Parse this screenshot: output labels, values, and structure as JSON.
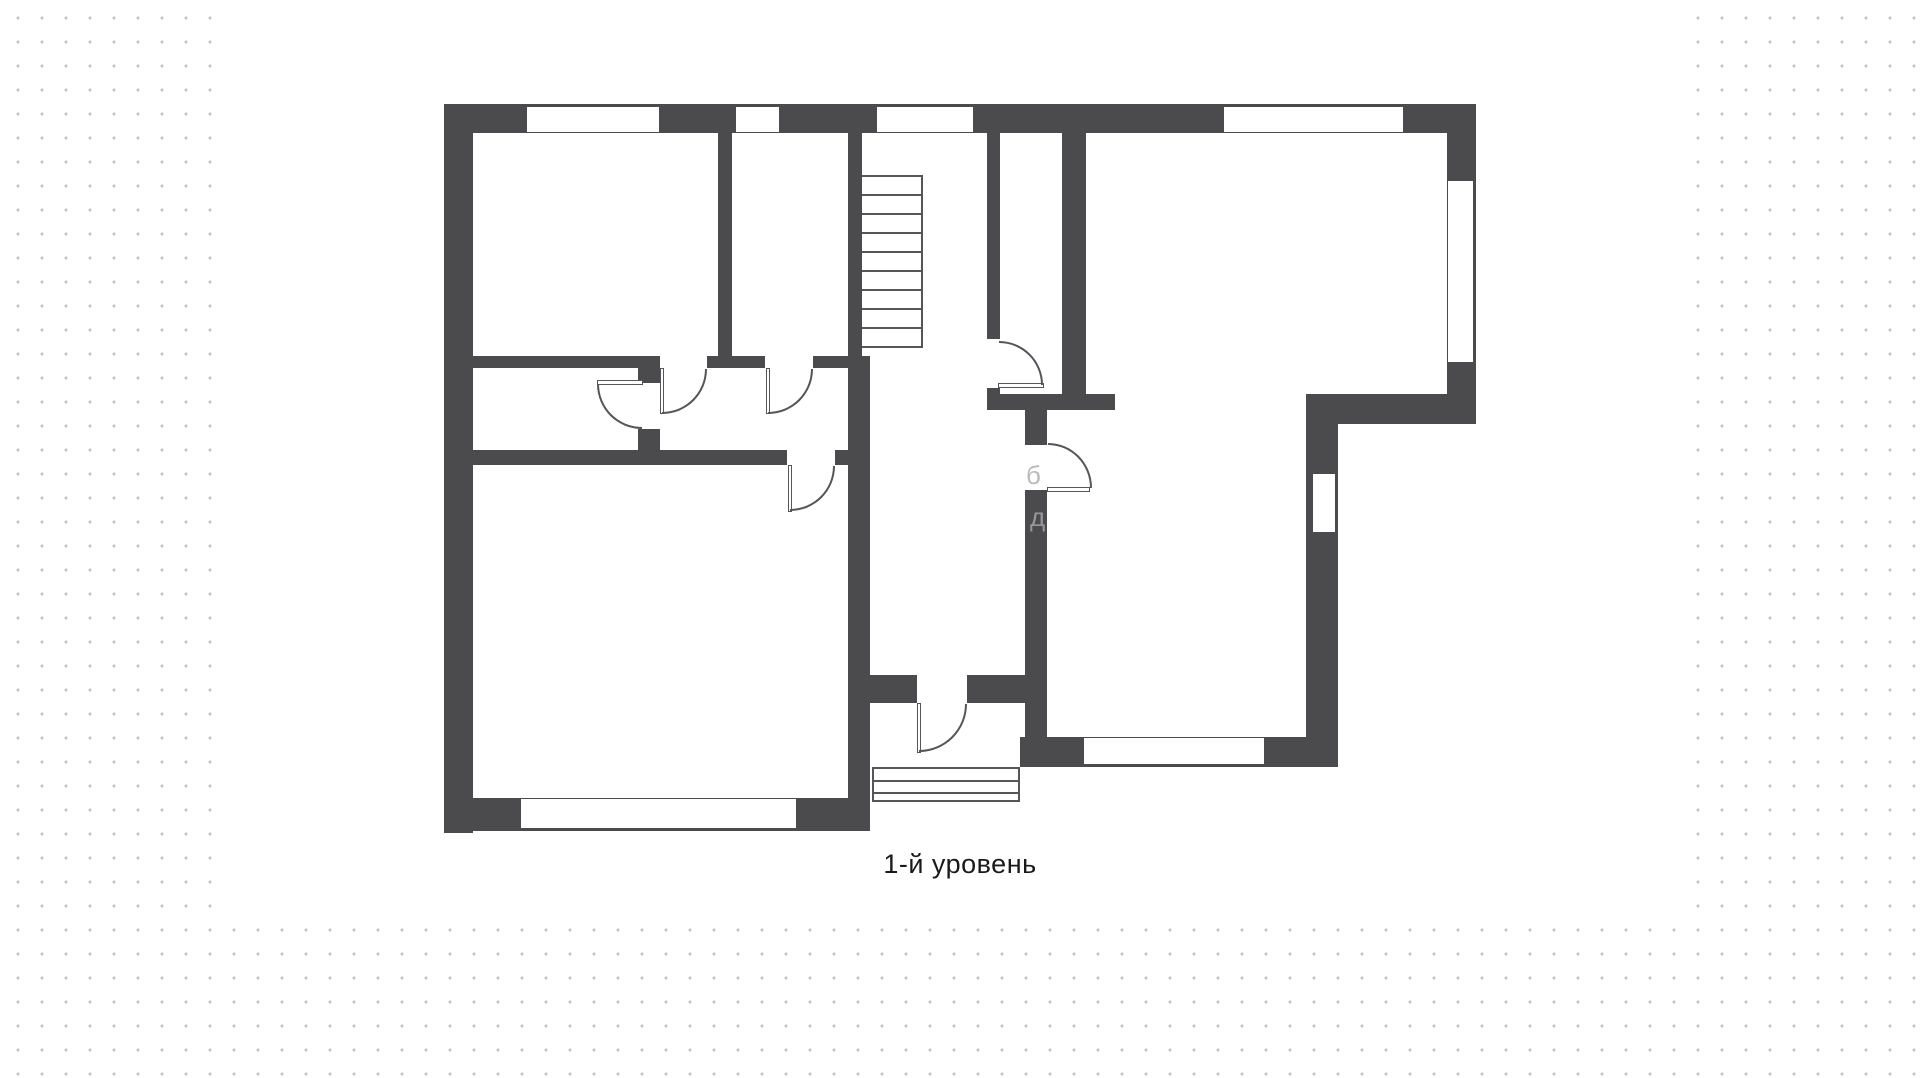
{
  "caption": {
    "text": "1-й уровень"
  },
  "colors": {
    "wall": "#4b4b4d",
    "line": "#55555a",
    "background_dot": "#c5c5c5",
    "sheet": "#ffffff",
    "caption_text": "#1a1a1a",
    "watermark": "#ababab"
  },
  "sheet": {
    "x": 230,
    "y": 0,
    "w": 1462,
    "h": 916
  },
  "plan": {
    "walls": [
      [
        444,
        104,
        1032,
        29
      ],
      [
        444,
        104,
        29,
        729
      ],
      [
        1447,
        104,
        29,
        320
      ],
      [
        1306,
        394,
        170,
        30
      ],
      [
        1306,
        424,
        32,
        343
      ],
      [
        1020,
        737,
        318,
        30
      ],
      [
        444,
        798,
        426,
        33
      ],
      [
        718,
        133,
        14,
        223
      ],
      [
        848,
        133,
        14,
        223
      ],
      [
        848,
        356,
        22,
        442
      ],
      [
        473,
        356,
        165,
        12
      ],
      [
        707,
        356,
        58,
        12
      ],
      [
        813,
        356,
        57,
        12
      ],
      [
        638,
        356,
        22,
        27
      ],
      [
        638,
        429,
        22,
        21
      ],
      [
        473,
        450,
        314,
        15
      ],
      [
        835,
        450,
        35,
        15
      ],
      [
        987,
        133,
        13,
        206
      ],
      [
        987,
        388,
        13,
        7
      ],
      [
        1062,
        133,
        24,
        261
      ],
      [
        987,
        394,
        128,
        16
      ],
      [
        1025,
        410,
        22,
        35
      ],
      [
        1025,
        490,
        22,
        247
      ],
      [
        870,
        675,
        47,
        28
      ],
      [
        967,
        675,
        58,
        28
      ]
    ],
    "windows": [
      {
        "r": [
          526,
          104,
          134,
          29
        ],
        "outer": "top"
      },
      {
        "r": [
          735,
          104,
          45,
          29
        ],
        "outer": "top"
      },
      {
        "r": [
          876,
          104,
          98,
          29
        ],
        "outer": "top"
      },
      {
        "r": [
          1223,
          104,
          181,
          29
        ],
        "outer": "top"
      },
      {
        "r": [
          1447,
          180,
          29,
          183
        ],
        "outer": "right"
      },
      {
        "r": [
          1312,
          473,
          26,
          60
        ],
        "outer": "right"
      },
      {
        "r": [
          1083,
          737,
          182,
          30
        ],
        "outer": "bottom"
      },
      {
        "r": [
          520,
          798,
          277,
          33
        ],
        "outer": "bottom"
      }
    ],
    "doors": [
      {
        "leaf": [
          660,
          368,
          4,
          46
        ],
        "arc": [
          662,
          369,
          45,
          45
        ],
        "dir": "se"
      },
      {
        "leaf": [
          766,
          368,
          4,
          46
        ],
        "arc": [
          768,
          369,
          45,
          45
        ],
        "dir": "se"
      },
      {
        "leaf": [
          597,
          380,
          46,
          5
        ],
        "arc": [
          597,
          384,
          45,
          45
        ],
        "dir": "sw"
      },
      {
        "leaf": [
          788,
          465,
          4,
          47
        ],
        "arc": [
          790,
          466,
          45,
          45
        ],
        "dir": "se"
      },
      {
        "leaf": [
          917,
          703,
          4,
          50
        ],
        "arc": [
          919,
          704,
          48,
          48
        ],
        "dir": "se"
      },
      {
        "leaf": [
          998,
          383,
          46,
          5
        ],
        "arc": [
          999,
          341,
          44,
          44
        ],
        "dir": "ne"
      },
      {
        "leaf": [
          1047,
          487,
          43,
          5
        ],
        "arc": [
          1048,
          443,
          44,
          45
        ],
        "dir": "ne"
      }
    ],
    "stairs": {
      "x": 862,
      "y": 175,
      "w": 61,
      "tread_count": 10,
      "spacing": 19
    },
    "steps": {
      "x": 872,
      "y": 767,
      "w": 148,
      "h": 35,
      "inner_lines": [
        11,
        23
      ]
    },
    "watermark": [
      {
        "t": "б",
        "x": 1026,
        "y": 462
      },
      {
        "t": "д",
        "x": 1030,
        "y": 504
      }
    ]
  }
}
